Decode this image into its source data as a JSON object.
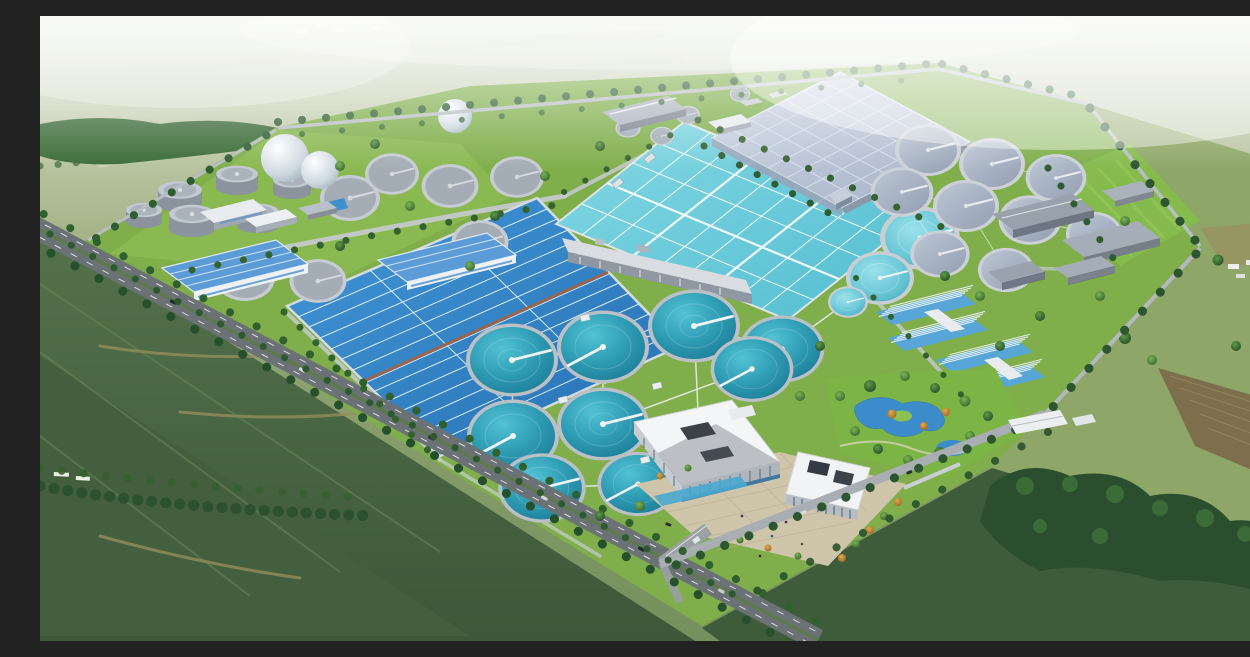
{
  "meta": {
    "title": "Aerial 3D rendering of a wastewater treatment plant",
    "alt": "Bird's-eye architectural rendering of a large wastewater treatment plant campus set in green farmland. The fenced site contains a dark-blue serpentine aeration basin, a large cyan gridded aeration pool, a pale grey covered process hall, rows of circular clarifier tanks (teal open tanks, light-cyan tanks and grey covered tanks), a digester tank farm with white gas spheres, blue-roofed warehouses, grey process buildings, blue-striped filter buildings, a landscaped garden pond, and a white administration complex with a paved entrance plaza. Tree-lined roads border the site and farm fields with woods surround it.",
    "no_visible_text": true
  },
  "scene": {
    "type": "architectural-3d-rendering",
    "view": "aerial bird's-eye",
    "setting": "rural farmland with woods, tilled fields and a small village on the hazy horizon",
    "site": {
      "shape": "large quadrilateral campus seen in perspective",
      "ground": "lawns with tree rows along all internal and boundary roads"
    },
    "features": {
      "pools": [
        {
          "name": "serpentine-aeration-basin",
          "description": "deep blue rectangular basin with serpentine channel lanes and a red-brown central walkway",
          "color": "#2f7fc0"
        },
        {
          "name": "gridded-aeration-pool",
          "description": "large light-cyan pool divided into many cells by white walkways",
          "color": "#6fccdb"
        },
        {
          "name": "covered-process-hall",
          "description": "huge pale blue-grey flat roof over covered basins, gridded panels",
          "color": "#b7c3d6"
        }
      ],
      "clarifiers": {
        "teal_open_tanks": 10,
        "cyan_open_tanks": 3,
        "grey_covered_tanks": 9,
        "detail": "white radial scraper-bridge arms and white connecting walkways",
        "teal_color": "#2f9db4"
      },
      "tank_farm": {
        "digester_cylinders": 6,
        "flat_grey_tanks": 9,
        "white_gas_spheres": 3
      },
      "buildings": {
        "blue_roof_warehouses": 2,
        "grey_process_buildings": 7,
        "blue_striped_filter_buildings": 4,
        "small_service_buildings": 12
      },
      "admin_complex": {
        "main_building": "white stepped flat-roof building with louvered glass facade and water channel",
        "second_building": "white building with vertical window stripes",
        "plaza": "beige paved entrance plaza with parked cars, people and amber ornamental trees"
      },
      "roads": {
        "main_road": "tree-lined dual carriageway along the south-west edge with vehicles",
        "boundary_roads": "tree-lined roads on all campus edges",
        "entrance": "gated entrance drive from the main road to the plaza"
      },
      "landscape": {
        "garden_pond": "curved blue ornamental pond in a landscaped garden",
        "woods": "dense dark tree masses at lower right and left",
        "fields": "green pasture, mowed strips and brown tilled plots",
        "village": "tiny white houses on the hazy horizon"
      }
    },
    "palette": {
      "haze": "#e8ecdf",
      "far_fields": "#b5c295",
      "near_fields": "#4a6742",
      "site_lawn": "#86b54e",
      "tree_dark": "#2c5a2f",
      "water_deep": "#2f7fc0",
      "water_cyan": "#6fccdb",
      "clarifier_teal": "#2f9db4",
      "covered_roof": "#b7c3d6",
      "blue_roof": "#5b9bd8",
      "concrete": "#c6ccd2",
      "road": "#6b7276",
      "plaza": "#cfc5ab",
      "autumn_tree": "#c8913f"
    }
  }
}
